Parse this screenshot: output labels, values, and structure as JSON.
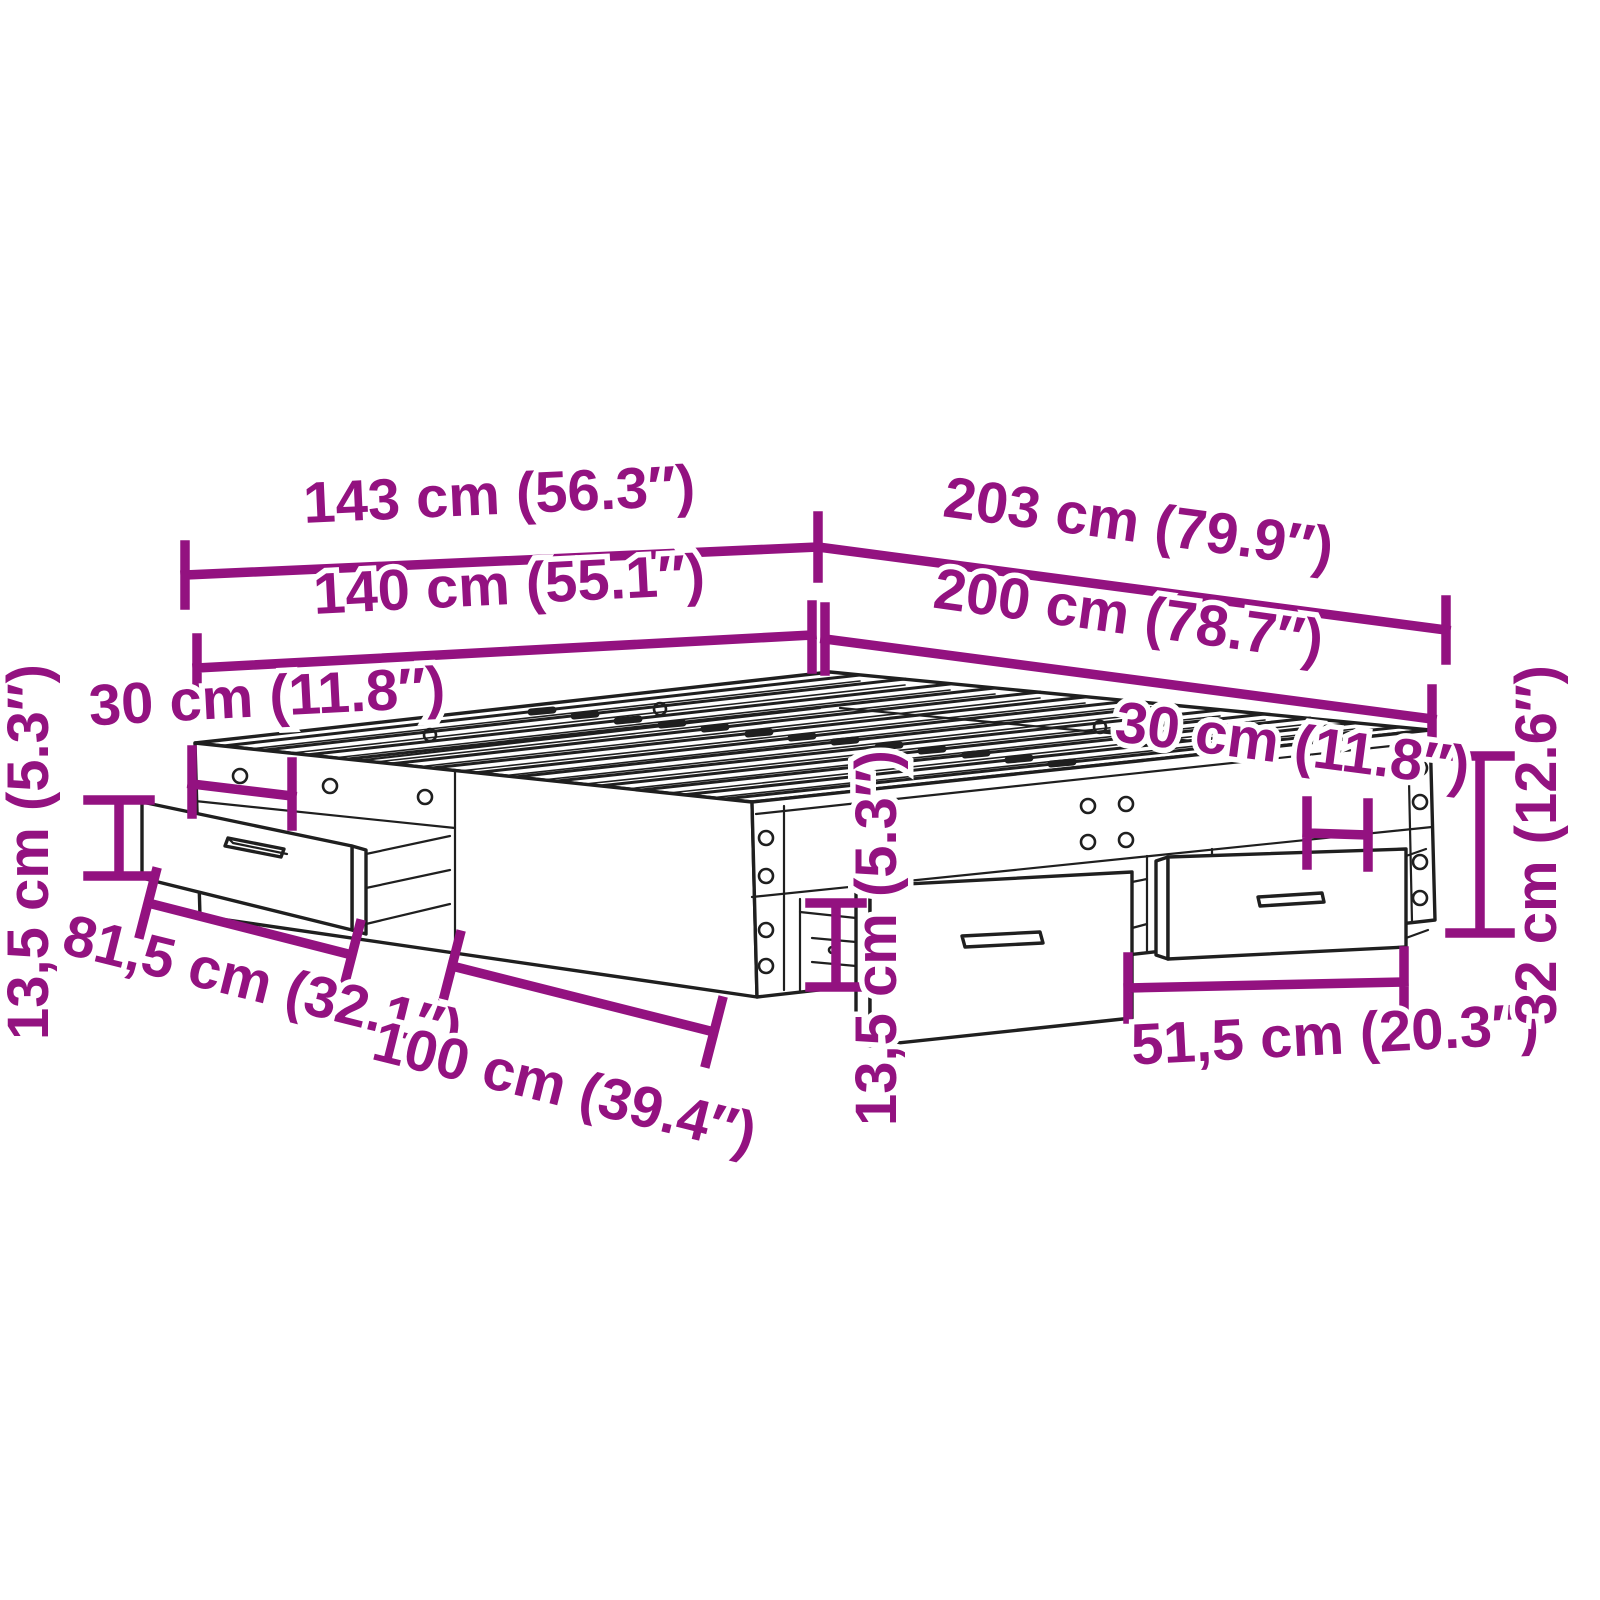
{
  "diagram": {
    "subject": "bed-frame-with-storage-drawers",
    "background_color": "#ffffff",
    "outline_color": "#1f1f1f",
    "dimension_color": "#931280",
    "dimensions": {
      "outer_width": "143 cm (56.3″)",
      "outer_length": "203 cm (79.9″)",
      "mattress_width": "140 cm (55.1″)",
      "mattress_length": "200 cm (78.7″)",
      "head_drawer_offset": "30 cm (11.8″)",
      "head_drawer_height": "13,5 cm (5.3″)",
      "head_drawer_front_width": "81,5 cm (32.1″)",
      "head_panel_width": "100 cm (39.4″)",
      "side_drawer_height": "13,5 cm (5.3″)",
      "side_drawer_offset": "30 cm (11.8″)",
      "side_drawer_front_width": "51,5 cm (20.3″)",
      "frame_height": "32 cm (12.6″)"
    }
  }
}
